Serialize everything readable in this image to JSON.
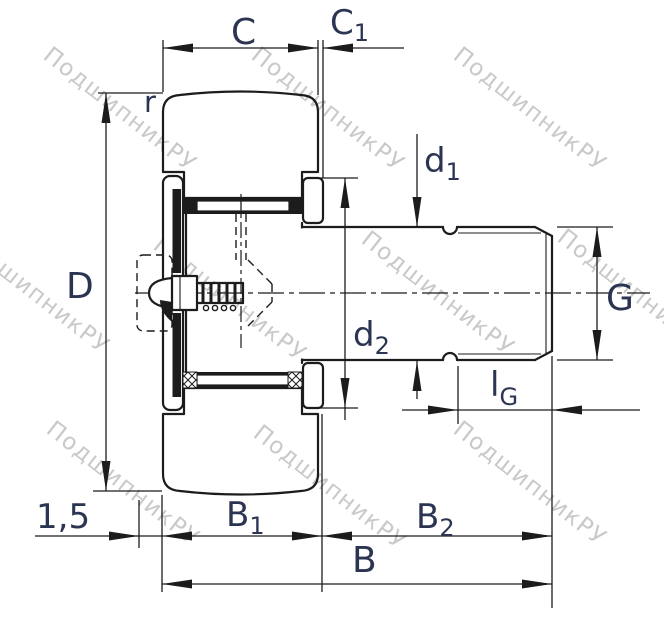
{
  "drawing": {
    "watermark": {
      "text": "ПодшипникРУ"
    },
    "labels": {
      "C": "C",
      "C1": {
        "main": "C",
        "sub": "1"
      },
      "r": "r",
      "D": "D",
      "d1": {
        "main": "d",
        "sub": "1"
      },
      "d2": {
        "main": "d",
        "sub": "2"
      },
      "G": "G",
      "lG": {
        "main": "l",
        "sub": "G"
      },
      "chamfer": "1,5",
      "B1": {
        "main": "B",
        "sub": "1"
      },
      "B2": {
        "main": "B",
        "sub": "2"
      },
      "B": "B"
    },
    "colors": {
      "label": "#2b3552",
      "line": "#1c1c1c",
      "watermark": "#c9c9c9",
      "background": "#ffffff"
    }
  }
}
